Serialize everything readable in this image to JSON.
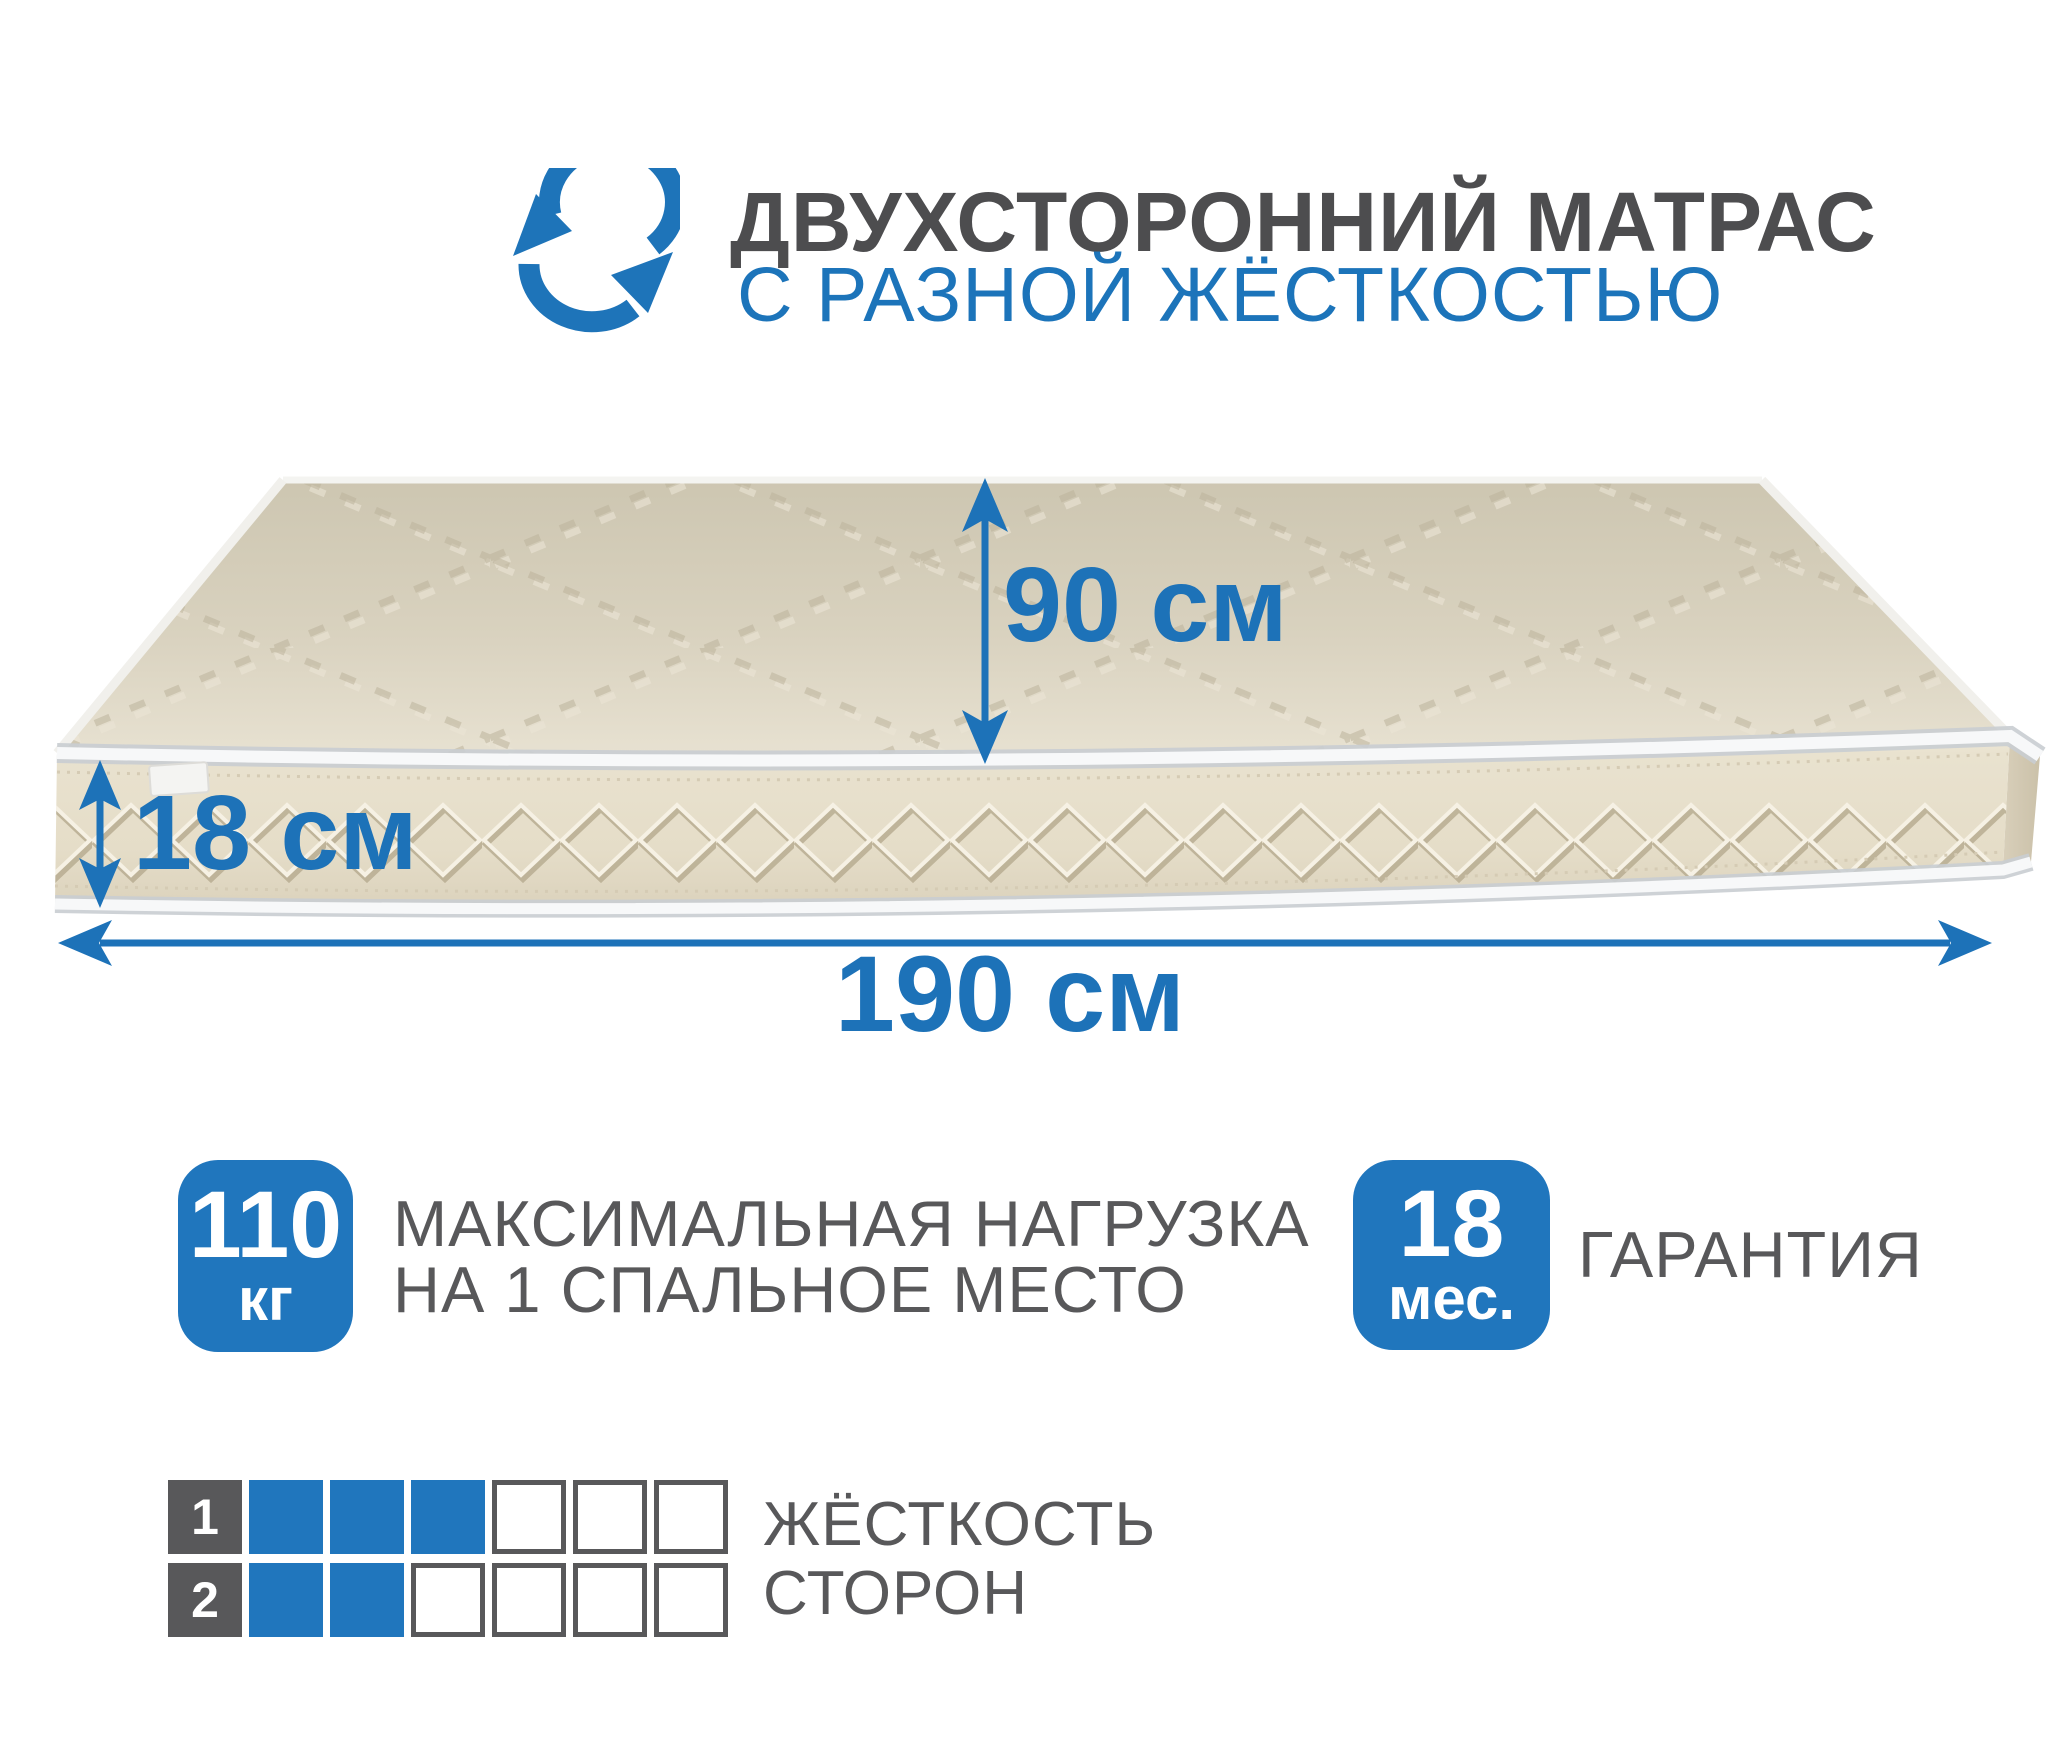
{
  "header": {
    "title": "ДВУХСТОРОННИЙ МАТРАС",
    "subtitle": "С РАЗНОЙ ЖЁСТКОСТЬЮ",
    "icon": "rotate-arrows-icon"
  },
  "dimensions": {
    "width_label": "90 см",
    "height_label": "18 см",
    "length_label": "190 см"
  },
  "badges": {
    "max_load": {
      "value": "110",
      "unit": "кг",
      "description_line1": "МАКСИМАЛЬНАЯ НАГРУЗКА",
      "description_line2": "НА 1 СПАЛЬНОЕ МЕСТО"
    },
    "warranty": {
      "value": "18",
      "unit": "мес.",
      "description": "ГАРАНТИЯ"
    }
  },
  "firmness": {
    "label_line1": "ЖЁСТКОСТЬ",
    "label_line2": "СТОРОН",
    "scale_max": 6,
    "rows": [
      {
        "side": "1",
        "filled": 3
      },
      {
        "side": "2",
        "filled": 2
      }
    ]
  },
  "colors": {
    "accent_blue": "#2076bd",
    "arrow_blue": "#1d72b8",
    "subtitle_blue": "#1c74ba",
    "title_gray": "#4d4d4f",
    "text_gray": "#58585a",
    "mattress_top": "#d9d2bf",
    "mattress_front": "#e7dfcc",
    "piping_white": "#f7f8f9"
  }
}
